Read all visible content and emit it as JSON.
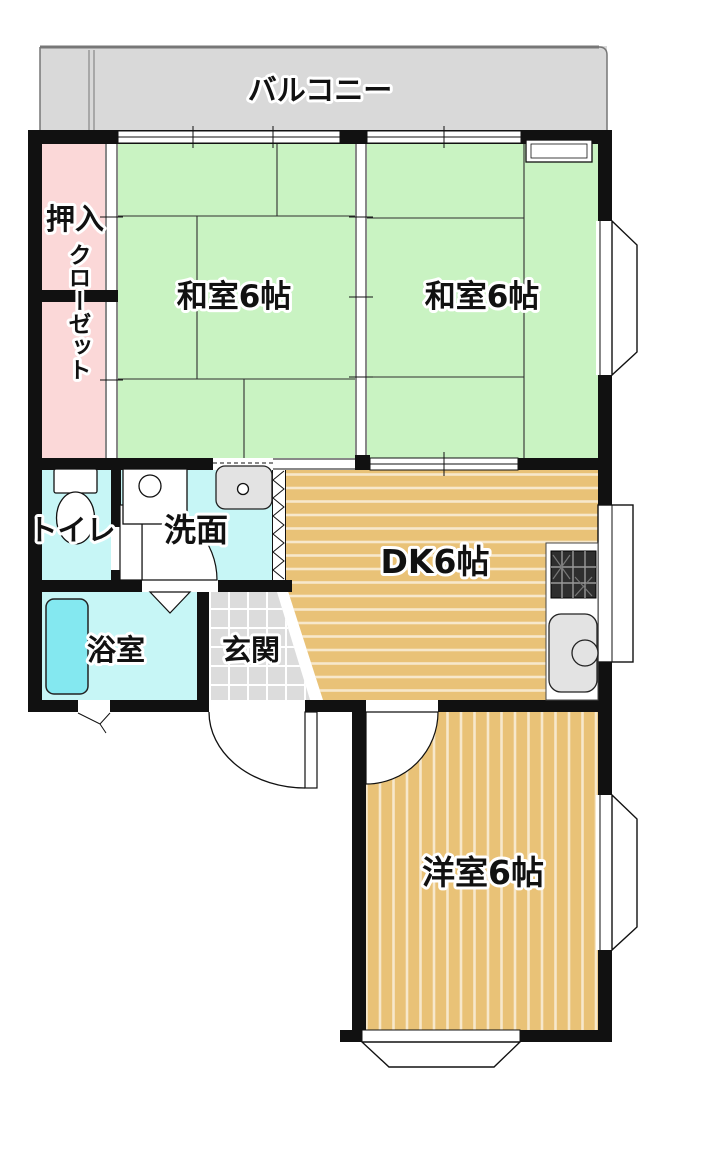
{
  "rooms": {
    "balcony": {
      "label": "バルコニー"
    },
    "oshiire": {
      "label": "押入"
    },
    "closet": {
      "label": "クローゼット"
    },
    "washitsu_left": {
      "label": "和室6帖"
    },
    "washitsu_right": {
      "label": "和室6帖"
    },
    "toilet": {
      "label": "トイレ"
    },
    "washroom": {
      "label": "洗面"
    },
    "dk": {
      "label": "DK6帖"
    },
    "bathroom": {
      "label": "浴室"
    },
    "entrance": {
      "label": "玄関"
    },
    "western_room": {
      "label": "洋室6帖"
    }
  },
  "colors": {
    "wall": "#111111",
    "tatami_green": "#c9f3c2",
    "closet_pink": "#fbd8d8",
    "wet_cyan": "#c7f6f6",
    "bathtub_cyan": "#84e8f0",
    "wood_floor": "#e9c277",
    "balcony_gray": "#d9d9d9",
    "entrance_tile": "#dcdcdc",
    "fixture_gray": "#e3e3e3",
    "stove_dark": "#2e2e2e"
  }
}
